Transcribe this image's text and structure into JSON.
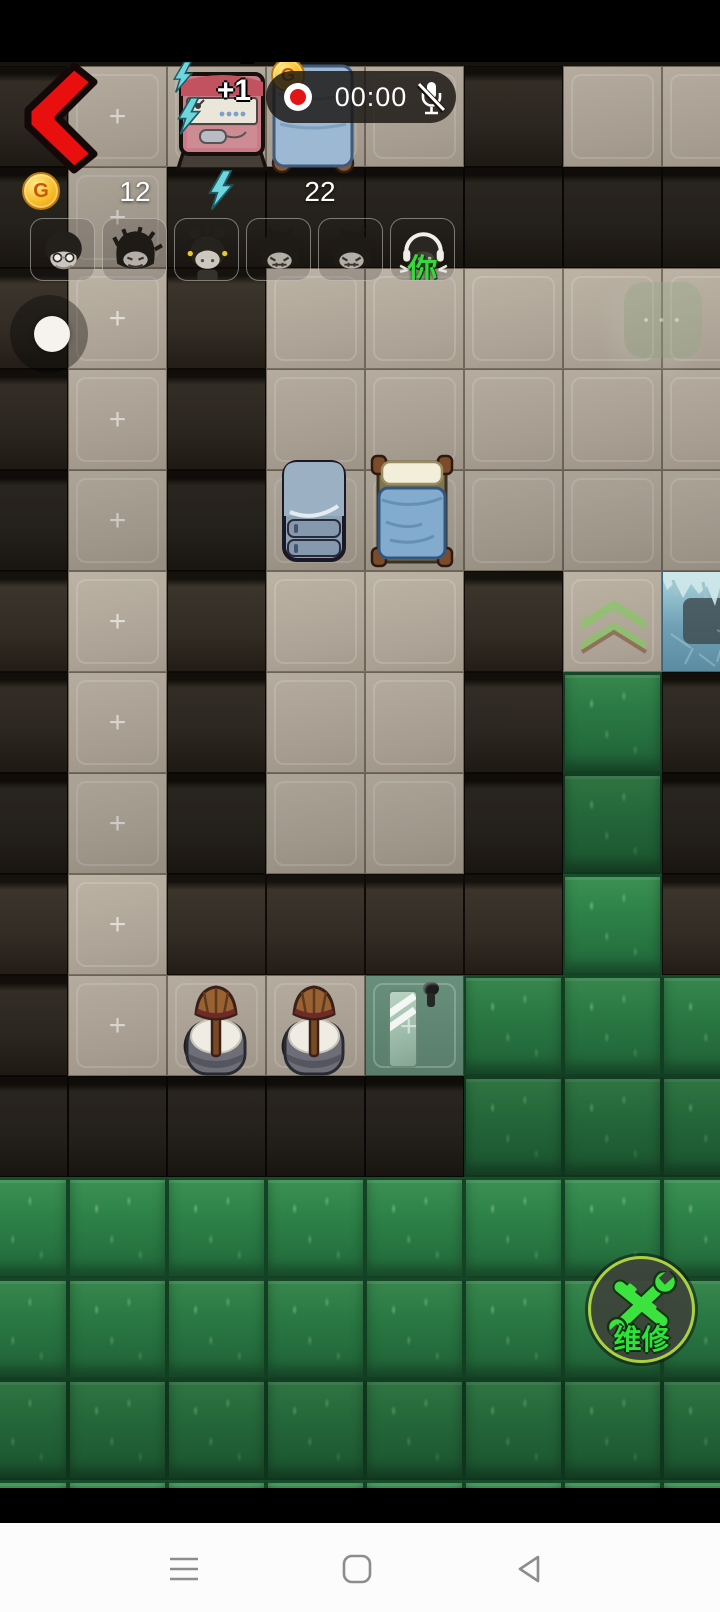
{
  "window": {
    "width": 720,
    "height": 1612,
    "platform_hint": "android-game"
  },
  "hud": {
    "recorder": {
      "time": "00:00",
      "state": "recording",
      "mic": "muted"
    },
    "coin_letter": "G",
    "coin_count": "12",
    "energy_count": "22",
    "bonus_popup": "+1",
    "floor_plus_mark": "+",
    "player_tag": "你",
    "repair_label": "维修",
    "faded_button_dots": "• • •"
  },
  "avatars": {
    "count": 6,
    "slots": [
      {
        "id": 1,
        "desc": "elder-with-glasses"
      },
      {
        "id": 2,
        "desc": "messy-hair-beard"
      },
      {
        "id": 3,
        "desc": "girl-with-buns-earrings"
      },
      {
        "id": 4,
        "desc": "messy-hair-grin"
      },
      {
        "id": 5,
        "desc": "messy-hair-grin"
      },
      {
        "id": 6,
        "desc": "player-headphones",
        "tag": "你"
      }
    ]
  },
  "tilemap": {
    "origin_x": -31,
    "origin_y": 66,
    "tile_w": 99,
    "tile_h": 101,
    "legend": {
      "D": "dark-wall",
      "F": "floor",
      "P": "floor-with-plus",
      "G": "grass",
      "C": "floor-upgrade-chevron",
      "I": "ice-block",
      "O": "door-floor"
    },
    "rows": [
      "DPFFFDFF",
      "DPDDDDDD",
      "DPDFFFFF",
      "DPDFFFFF",
      "DPDFFFFF",
      "DPDFFDCI",
      "DPDFFDGD",
      "DPDFFDGD",
      "DPDDDDGD",
      "DPFFOGGG",
      "DDDDDGGG",
      "GGGGGGGG",
      "GGGGGGGG",
      "GGGGGGGG",
      "GGGGGGGG"
    ]
  },
  "colors": {
    "record_red": "#e31414",
    "coin_gold": "#f6bd27",
    "energy_teal": "#6fd6de",
    "repair_green": "#2fe23a",
    "repair_ring": "#a9d23e",
    "back_arrow_red": "#e90f0f",
    "grass": "#2b7a44",
    "floor": "#a99f92",
    "wall": "#2b2620",
    "navbar_icon": "#8d8d8d"
  }
}
